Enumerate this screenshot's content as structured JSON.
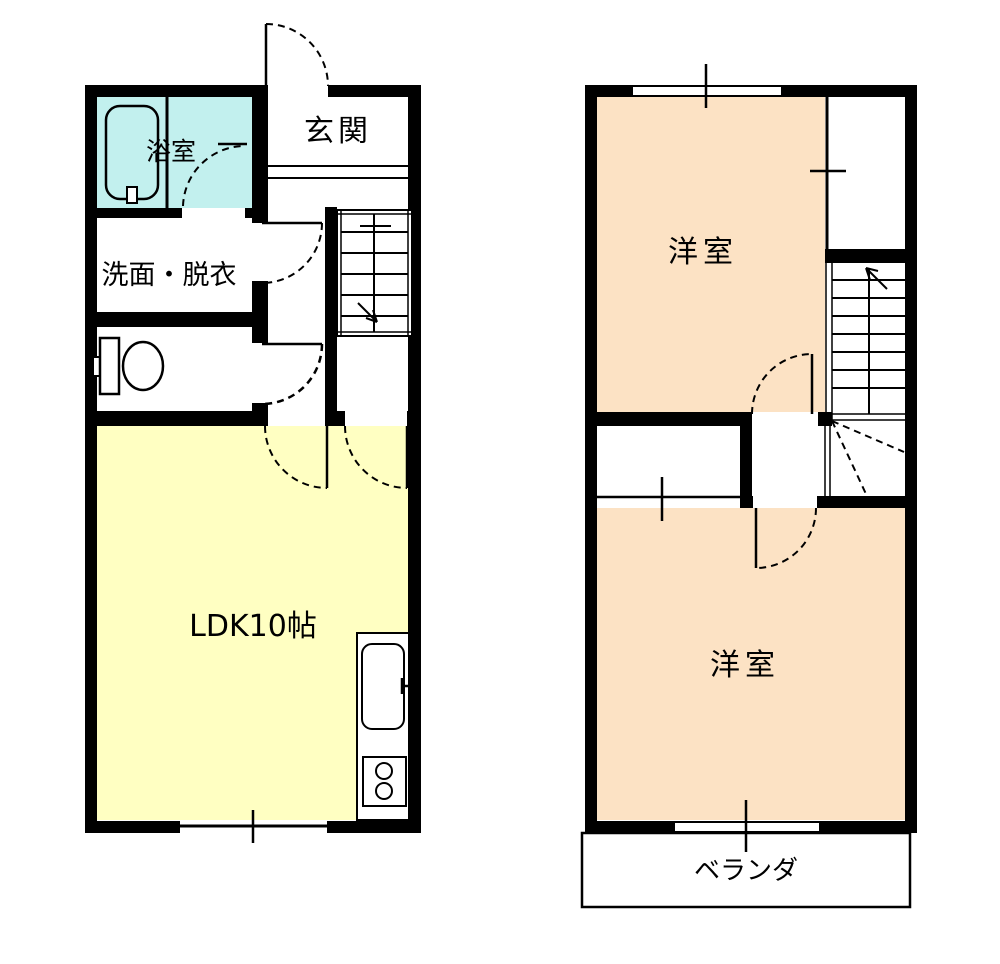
{
  "plan": {
    "floor1": {
      "bathroom_label": "浴室",
      "washroom_label": "洗面・脱衣",
      "entrance_label": "玄関",
      "ldk_label": "LDK10帖"
    },
    "floor2": {
      "room_top_label": "洋室",
      "room_bottom_label": "洋室",
      "veranda_label": "ベランダ"
    },
    "colors": {
      "wall": "#000000",
      "bathroom_fill": "#c2f0ee",
      "ldk_fill": "#ffffc2",
      "bedroom_fill": "#fce2c4",
      "background": "#ffffff"
    }
  }
}
